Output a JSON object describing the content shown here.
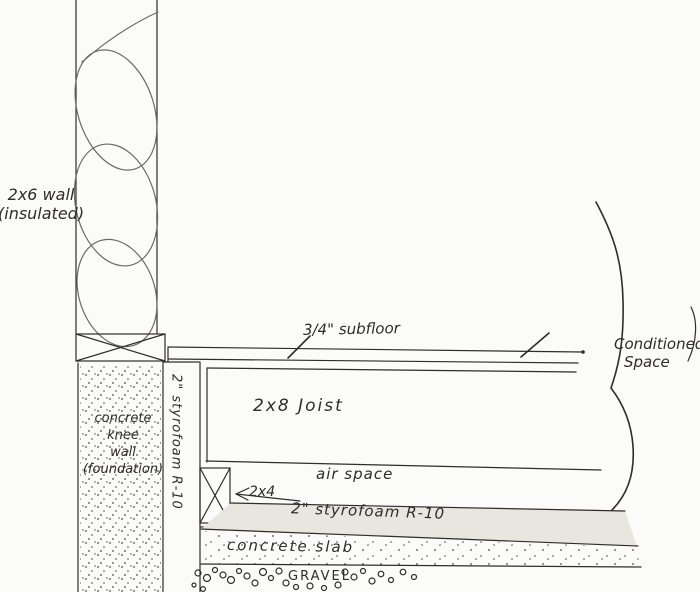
{
  "labels": {
    "wall_line1": "2x6 wall",
    "wall_line2": "(insulated)",
    "subfloor": "3/4\" subfloor",
    "joist": "2x8 Joist",
    "air_space": "air space",
    "two_by_four": "2x4",
    "styrofoam_horizontal": "2\" styrofoam R-10",
    "styrofoam_vertical": "2\" styrofoam R-10",
    "knee_line1": "concrete",
    "knee_line2": "knee",
    "knee_line3": "wall",
    "knee_line4": "(foundation)",
    "slab": "concrete slab",
    "gravel": "GRAVEL",
    "conditioned_line1": "Conditioned",
    "conditioned_line2": "Space"
  },
  "colors": {
    "ink": "#2e2d2b",
    "pencil": "#6b6b6b",
    "paper": "#fbfbf9",
    "foam": "#e9e6df",
    "stip": "#4a4a4a"
  }
}
